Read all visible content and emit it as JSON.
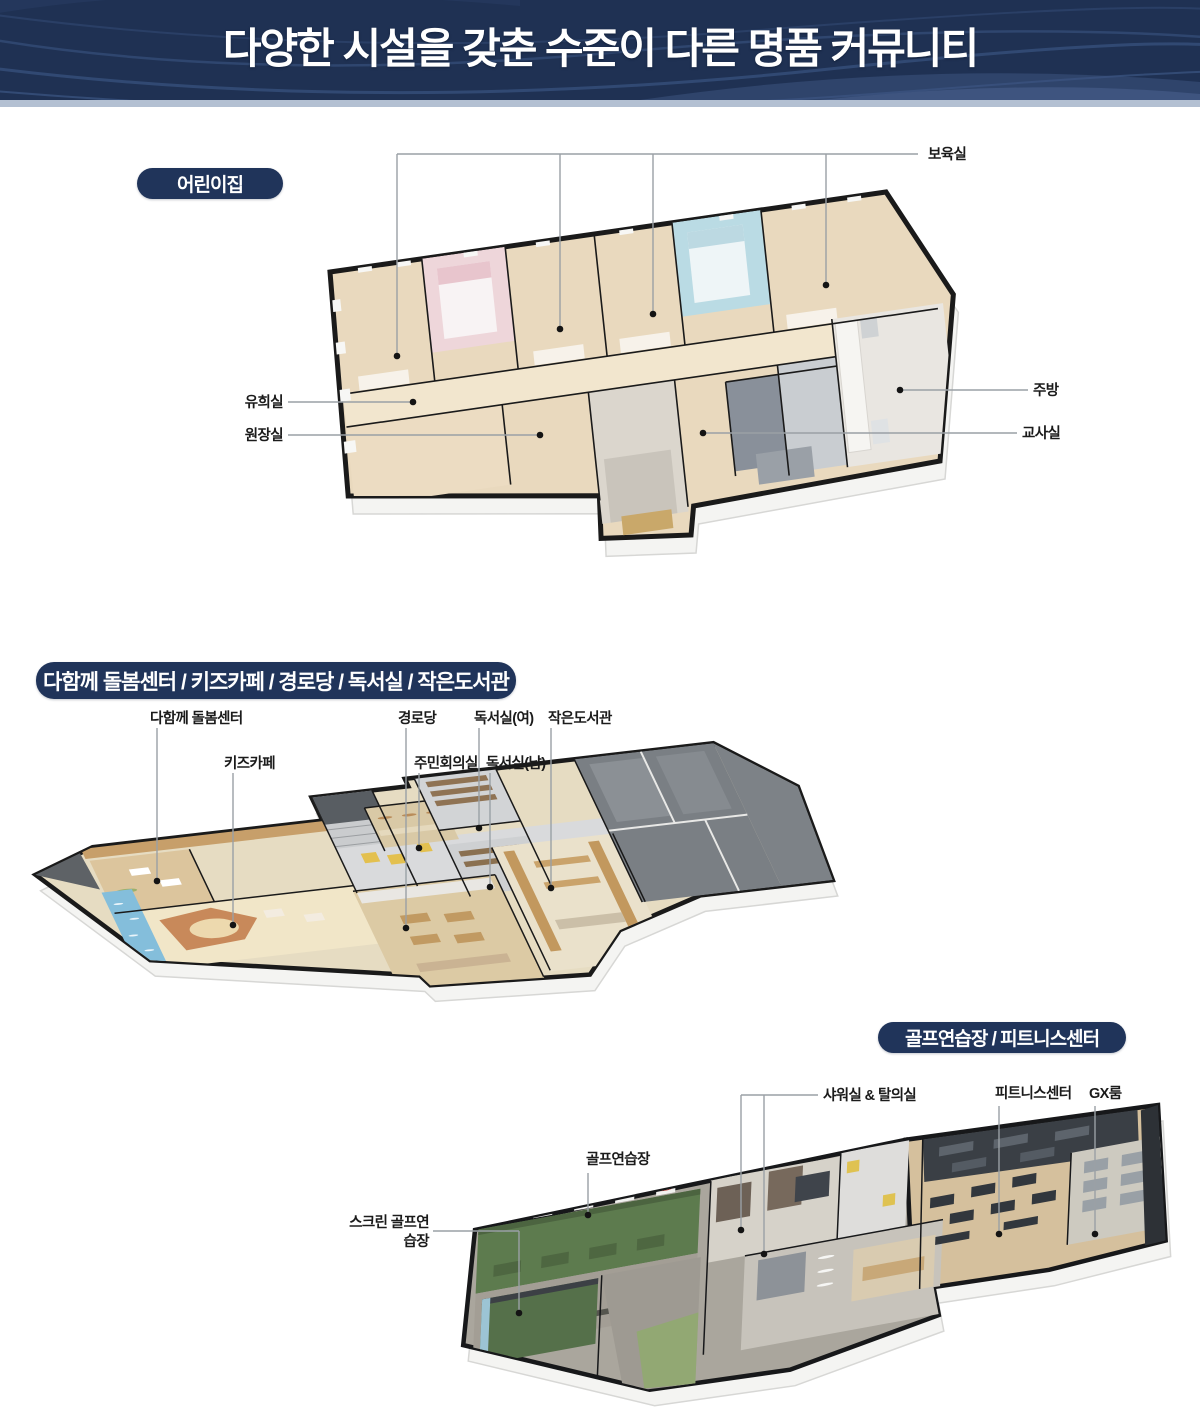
{
  "header": {
    "title": "다양한 시설을 갖춘 수준이 다른 명품 커뮤니티"
  },
  "sections": [
    {
      "id": "daycare",
      "pill_label": "어린이집",
      "labels": {
        "boyuk": "보육실",
        "yuhee": "유희실",
        "wonjang": "원장실",
        "jubang": "주방",
        "gyosa": "교사실"
      }
    },
    {
      "id": "care-center",
      "pill_label": "다함께 돌봄센터 / 키즈카페 / 경로당 / 독서실 / 작은도서관",
      "labels": {
        "dolbom": "다함께 돌봄센터",
        "kids": "키즈카페",
        "gyeongro": "경로당",
        "jumin": "주민회의실",
        "reading_f": "독서실(여)",
        "reading_m": "독서실(남)",
        "library": "작은도서관"
      }
    },
    {
      "id": "golf-fitness",
      "pill_label": "골프연습장 / 피트니스센터",
      "labels": {
        "shower": "샤워실 & 탈의실",
        "golf": "골프연습장",
        "screen_golf": "스크린 골프연습장",
        "fitness": "피트니스센터",
        "gx": "GX룸"
      }
    }
  ],
  "colors": {
    "header_bg": "#1f3153",
    "header_band": "#b3c0d2",
    "pill_bg": "#20345a",
    "label_text": "#1b1b1b",
    "leader_line": "#9aa0a5",
    "wood_floor": "#e9d9be",
    "golf_green": "#5d7b4e"
  }
}
